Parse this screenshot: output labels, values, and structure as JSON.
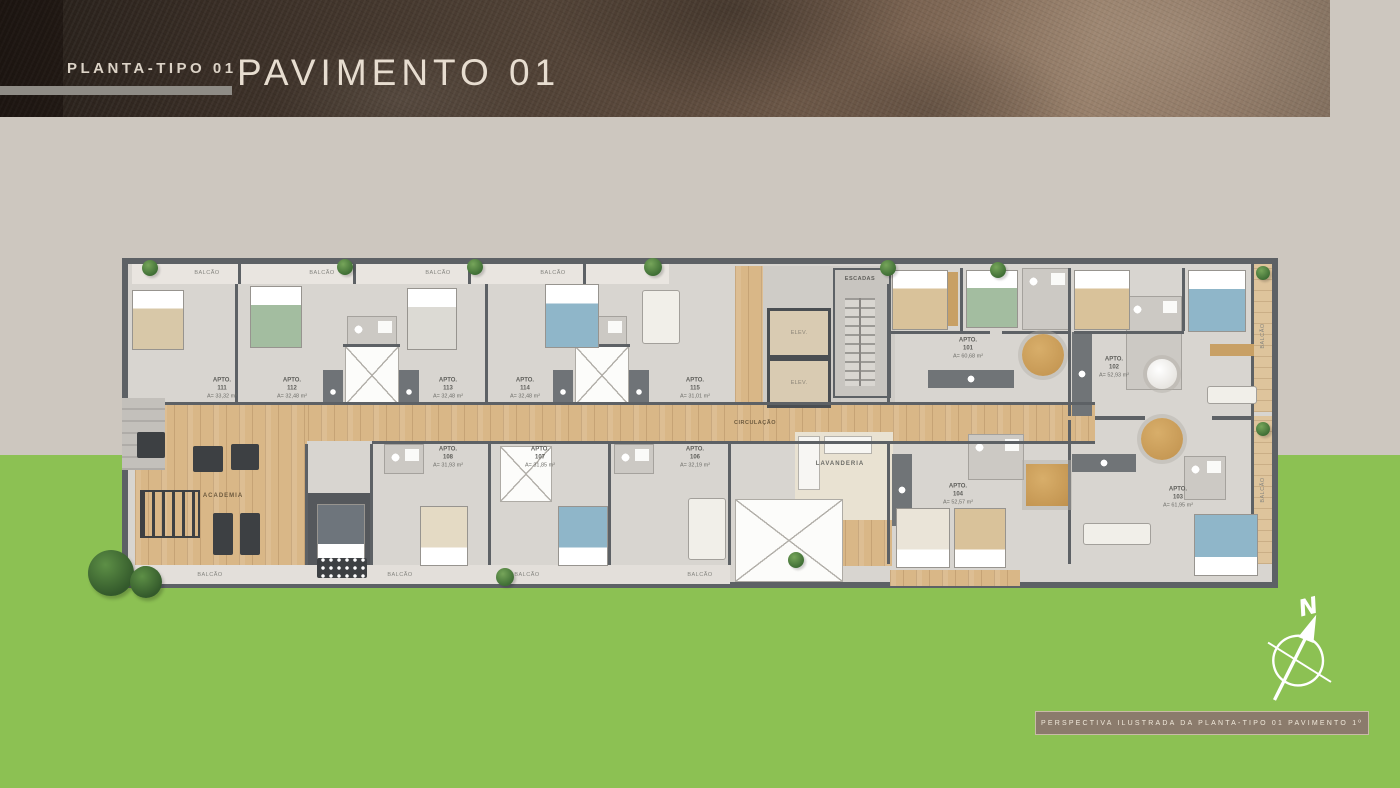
{
  "header": {
    "kicker": "PLANTA-TIPO 01",
    "title": "PAVIMENTO 01"
  },
  "plan": {
    "labels": {
      "circulation": "CIRCULAÇÃO",
      "gym": "ACADEMIA",
      "laundry": "LAVANDERIA",
      "stairs": "ESCADAS",
      "elevator": "ELEV.",
      "balcony": "BALCÃO"
    },
    "apartments": [
      {
        "label": "APTO.",
        "number": "111",
        "area": "A= 33,32 m²"
      },
      {
        "label": "APTO.",
        "number": "112",
        "area": "A= 32,48 m²"
      },
      {
        "label": "APTO.",
        "number": "113",
        "area": "A= 32,48 m²"
      },
      {
        "label": "APTO.",
        "number": "114",
        "area": "A= 32,48 m²"
      },
      {
        "label": "APTO.",
        "number": "115",
        "area": "A= 31,01 m²"
      },
      {
        "label": "APTO.",
        "number": "101",
        "area": "A= 60,68 m²"
      },
      {
        "label": "APTO.",
        "number": "102",
        "area": "A= 52,93 m²"
      },
      {
        "label": "APTO.",
        "number": "108",
        "area": "A= 31,93 m²"
      },
      {
        "label": "APTO.",
        "number": "107",
        "area": "A= 31,85 m²"
      },
      {
        "label": "APTO.",
        "number": "106",
        "area": "A= 32,19 m²"
      },
      {
        "label": "APTO.",
        "number": "104",
        "area": "A= 52,57 m²"
      },
      {
        "label": "APTO.",
        "number": "103",
        "area": "A= 61,95 m²"
      }
    ]
  },
  "compass": {
    "north": "N"
  },
  "caption": {
    "text": "PERSPECTIVA ILUSTRADA DA PLANTA-TIPO 01 PAVIMENTO 1º"
  },
  "colors": {
    "green": "#8cc153",
    "header_brown": "#3a2f27",
    "accent_beige": "#e7ddd0",
    "wood": "#d9b787"
  }
}
